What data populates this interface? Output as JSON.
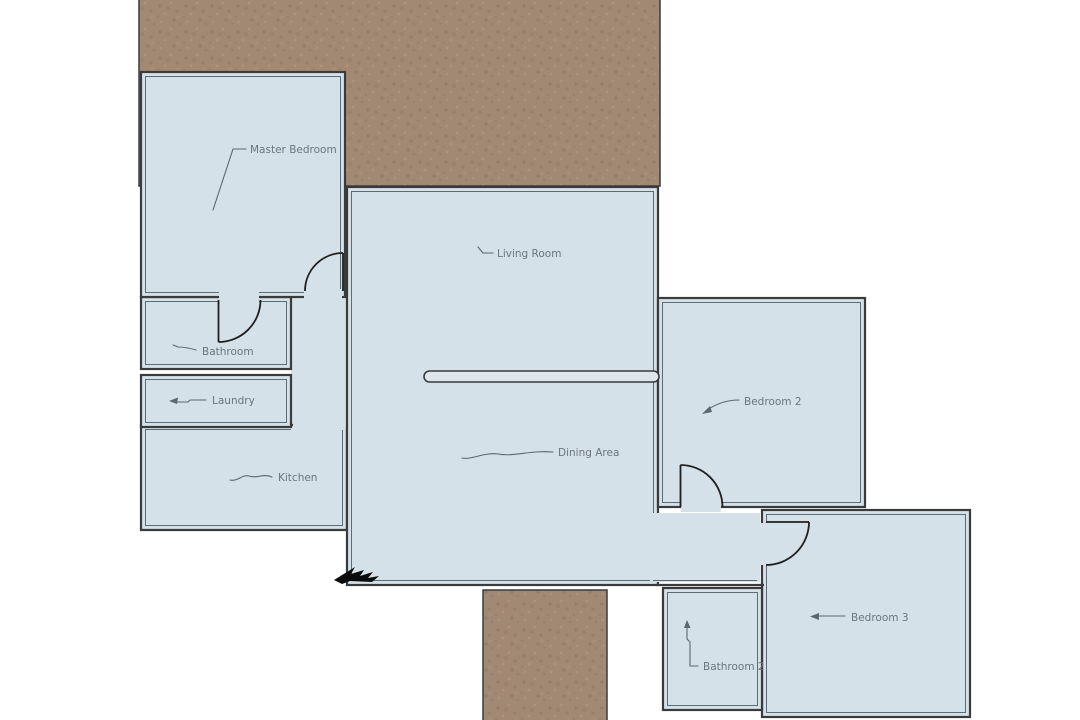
{
  "diagram": {
    "type": "floor-plan",
    "rooms": [
      {
        "id": "master-bedroom",
        "label": "Master Bedroom"
      },
      {
        "id": "bathroom",
        "label": "Bathroom"
      },
      {
        "id": "laundry",
        "label": "Laundry"
      },
      {
        "id": "kitchen",
        "label": "Kitchen"
      },
      {
        "id": "living-room",
        "label": "Living Room"
      },
      {
        "id": "dining-area",
        "label": "Dining Area"
      },
      {
        "id": "bedroom-2",
        "label": "Bedroom 2"
      },
      {
        "id": "bedroom-3",
        "label": "Bedroom 3"
      },
      {
        "id": "bathroom-2",
        "label": "Bathroom 2"
      }
    ],
    "colors": {
      "room_fill": "#d5e1e9",
      "wall": "#3b3b3b",
      "ground": "#a28974",
      "label_text": "#6b7580",
      "entry_marker": "#0b0b0b"
    }
  }
}
